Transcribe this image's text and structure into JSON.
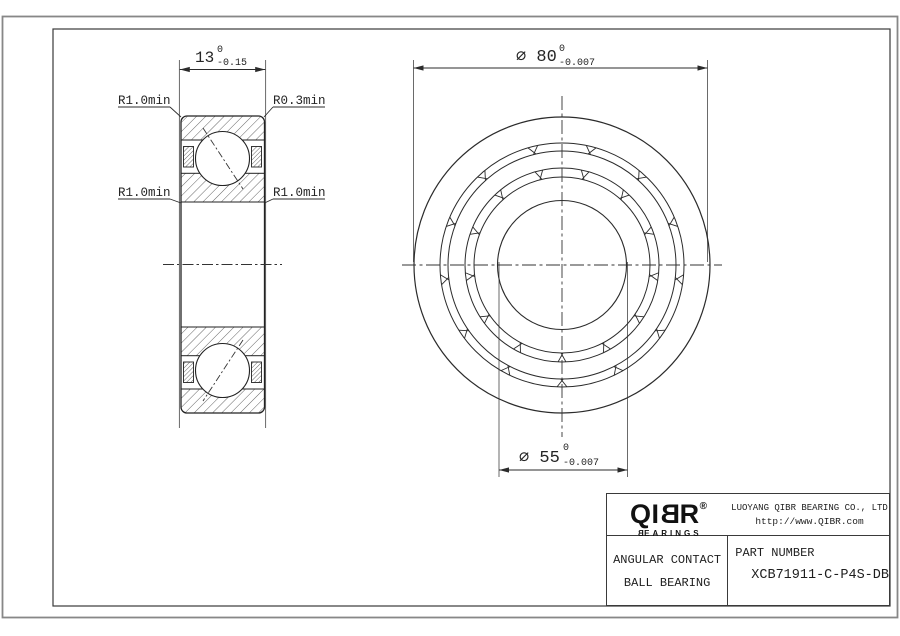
{
  "views": {
    "section": {
      "width_dim": {
        "value": "13",
        "tol_upper": "0",
        "tol_lower": "-0.15"
      },
      "fillet_top_left": "R1.0min",
      "fillet_top_right": "R0.3min",
      "fillet_mid_left": "R1.0min",
      "fillet_mid_right": "R1.0min"
    },
    "front": {
      "outer_diameter": {
        "display": "∅ 80",
        "tol_upper": "0",
        "tol_lower": "-0.007"
      },
      "bore_diameter": {
        "display": "∅ 55",
        "tol_upper": "0",
        "tol_lower": "-0.007"
      }
    }
  },
  "title_block": {
    "logo": {
      "left": "QI",
      "mirrored_letter": "B",
      "right": "R",
      "registered": "®",
      "sub_mirrored": "B",
      "sub_rest": "EARINGS"
    },
    "company": "LUOYANG QIBR BEARING CO., LTD",
    "website": "http://www.QIBR.com",
    "product_line1": "ANGULAR CONTACT",
    "product_line2": "BALL BEARING",
    "part_number_label": "PART NUMBER",
    "part_number": "XCB71911-C-P4S-DB"
  },
  "colors": {
    "line": "#2b2b2b",
    "frame_outer": "#878787",
    "frame_inner": "#3a3a3a",
    "hatch": "#3f3f3f"
  }
}
